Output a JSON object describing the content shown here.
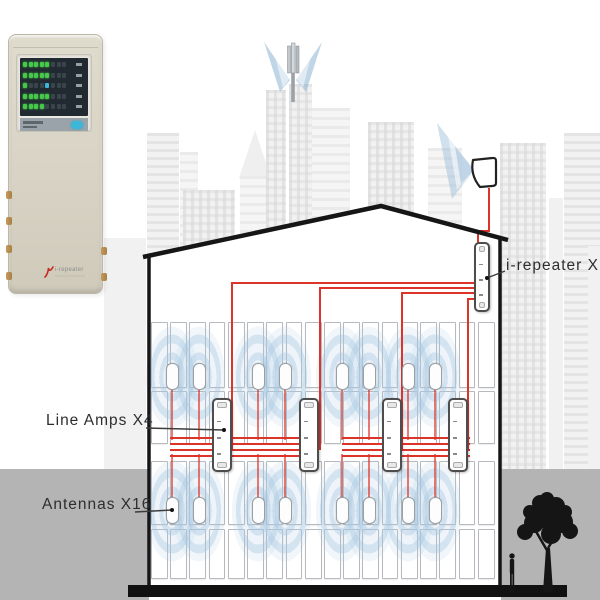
{
  "title": "In-building repeater system diagram",
  "callouts": [
    {
      "id": "line-amps",
      "text": "Line Amps X4",
      "x": 46,
      "y": 412,
      "leader": [
        [
          146,
          428
        ],
        [
          224,
          430
        ]
      ]
    },
    {
      "id": "antennas",
      "text": "Antennas X16",
      "x": 42,
      "y": 496,
      "leader": [
        [
          135,
          512
        ],
        [
          172,
          510
        ]
      ]
    },
    {
      "id": "repeater",
      "text": "i-repeater X1",
      "x": 506,
      "y": 257,
      "leader": [
        [
          505,
          271
        ],
        [
          487,
          278
        ]
      ]
    }
  ],
  "devices": {
    "repeater_unit": {
      "name": "i-repeater",
      "count": 1,
      "x": 474,
      "y": 242,
      "w": 16,
      "h": 70
    },
    "line_amps": {
      "name": "Line Amp",
      "count": 4,
      "xs": [
        222,
        309,
        392,
        458
      ],
      "y": 398,
      "w": 20,
      "h": 74
    },
    "antennas": {
      "name": "Antenna",
      "count": 16,
      "xs": [
        172,
        199,
        258,
        285,
        342,
        369,
        408,
        435
      ],
      "upper_y": 363,
      "lower_y": 497,
      "w": 13,
      "h": 27
    }
  },
  "building": {
    "floors": [
      {
        "y": 322,
        "h": 66
      },
      {
        "y": 391,
        "h": 53
      },
      {
        "y": 461,
        "h": 64
      },
      {
        "y": 529,
        "h": 50
      }
    ],
    "interior": {
      "x1": 151,
      "x2": 497,
      "cols": 18
    },
    "walls": {
      "left_x": 149,
      "right_x": 500,
      "top_left_y": 254,
      "top_right_y": 238,
      "bottom_y": 585
    },
    "roof": {
      "left": [
        143,
        257
      ],
      "peak": [
        381,
        206
      ],
      "right": [
        508,
        240
      ]
    }
  },
  "cables": {
    "antenna_feed": [
      [
        489,
        188
      ],
      [
        489,
        231
      ],
      [
        478,
        231
      ],
      [
        478,
        243
      ]
    ],
    "feed_origin_x": 475,
    "feeds": [
      {
        "y": 283,
        "x": 232
      },
      {
        "y": 288,
        "x": 320
      },
      {
        "y": 293,
        "x": 402
      },
      {
        "y": 299,
        "x": 468
      }
    ],
    "riser_bottom": 450,
    "bundles": [
      {
        "x1": 170,
        "x2": 305
      },
      {
        "x1": 342,
        "x2": 470
      }
    ],
    "bundle_ys": [
      438,
      444,
      450,
      456
    ],
    "antenna_drops": {
      "upper": [
        388,
        440
      ],
      "lower": [
        454,
        498
      ]
    }
  },
  "device_panel": {
    "brand": "i-repeater",
    "led_rows": [
      {
        "green": 5,
        "dark": 3,
        "cyan": -1
      },
      {
        "green": 5,
        "dark": 3,
        "cyan": -1
      },
      {
        "green": 1,
        "dark": 7,
        "cyan": 4
      },
      {
        "green": 5,
        "dark": 3,
        "cyan": -1
      },
      {
        "green": 4,
        "dark": 4,
        "cyan": -1
      }
    ]
  },
  "colors": {
    "cable_red": "#dd342a",
    "coverage_blue": "#a8c8e2",
    "outline_black": "#161616",
    "ground_gray": "#b4b4b4",
    "device_beige": "#d8d3c4",
    "led_green": "#46c84a",
    "accent_cyan": "#3ab7d9",
    "leader_gray": "#3c3c3c"
  }
}
